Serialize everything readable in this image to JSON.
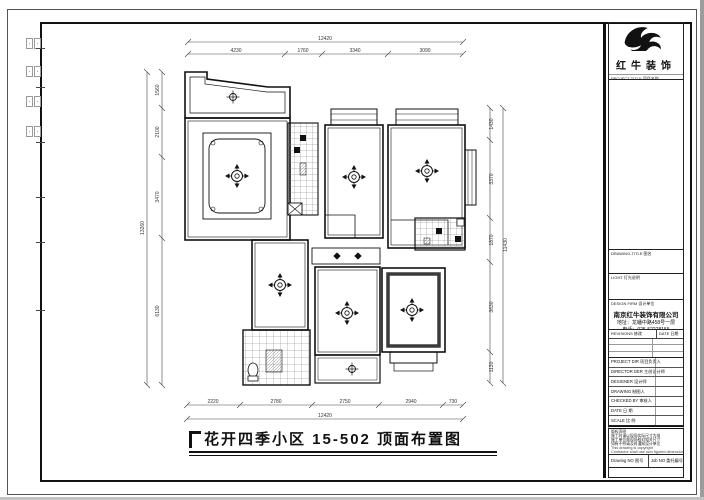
{
  "plan": {
    "title": "花开四季小区 15-502 顶面布置图",
    "dims": {
      "top_total": "12420",
      "top_segments": [
        "4230",
        "1760",
        "3340",
        "3090"
      ],
      "bottom_segments": [
        "2220",
        "2780",
        "2750",
        "2940",
        "730"
      ],
      "bottom_total": "12420",
      "left_segments": [
        "1560",
        "2100",
        "3470",
        "6130"
      ],
      "left_total": "13260",
      "right_segments": [
        "1430",
        "3370",
        "1870",
        "3630",
        "1130"
      ],
      "right_total": "11430"
    }
  },
  "titleblock": {
    "brand": "红牛装饰",
    "project_title_label": "PROJECT-TITLE 项目名称",
    "drawing_title_label": "DRAWING-TITLE 图名",
    "light_label": "LIGHT 灯光说明",
    "design_firm_label": "DESIGN FIRM 设计单位",
    "company_name": "南京红牛装饰有限公司",
    "company_address": "地址：龙蟠中路458号一层",
    "company_phone": "电话：025-52228155",
    "revisions_label": "REVISIONS 修改",
    "date_col_label": "DATE 日期",
    "rows": [
      "PROJECT DIR 项目负责人",
      "DIRECTOR DER 主创设计师",
      "DESIGNER 设计师",
      "DRAWING 制图人",
      "CHECKED BY 审核人",
      "DATE 日 期",
      "SCALE 比 例"
    ],
    "notes": [
      "版权声明",
      "施工时请以现场实际尺寸为准",
      "施工单位需现场核对相关尺寸",
      "如有不符请及时通知设计单位",
      "This drawing is copyright",
      "Contractor shall use own figured dimensions only",
      "Contractor must check all dimensions on site",
      "Mistakes must be reported immediately to architect"
    ],
    "drawing_no_label": "Drawing NO 图号",
    "job_no_label": "Job NO 委托编号"
  }
}
